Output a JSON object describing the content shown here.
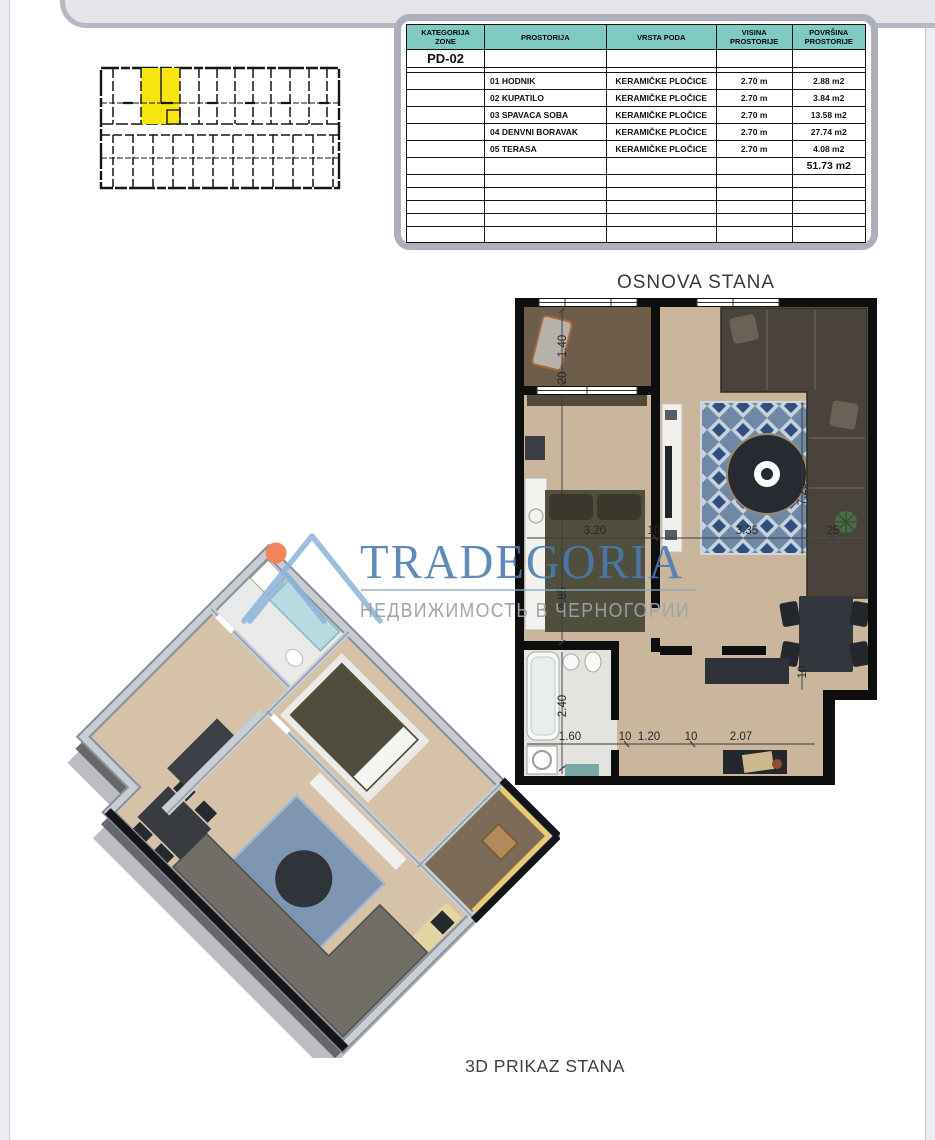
{
  "table": {
    "headers": {
      "col1": "KATEGORIJA\nZONE",
      "col2": "PROSTORIJA",
      "col3": "VRSTA PODA",
      "col4": "VISINA\nPROSTORIJE",
      "col5": "POVRŠINA\nPROSTORIJE"
    },
    "zone": "PD-02",
    "rows": [
      {
        "name": "01 HODNIK",
        "floor": "KERAMIČKE PLOČICE",
        "height": "2.70 m",
        "area": "2.88 m2"
      },
      {
        "name": "02 KUPATILO",
        "floor": "KERAMIČKE PLOČICE",
        "height": "2.70 m",
        "area": "3.84 m2"
      },
      {
        "name": "03 SPAVACA SOBA",
        "floor": "KERAMIČKE PLOČICE",
        "height": "2.70 m",
        "area": "13.58 m2"
      },
      {
        "name": "04 DENVNI BORAVAK",
        "floor": "KERAMIČKE PLOČICE",
        "height": "2.70 m",
        "area": "27.74 m2"
      },
      {
        "name": "05 TERASA",
        "floor": "KERAMIČKE PLOČICE",
        "height": "2.70 m",
        "area": "4.08 m2"
      }
    ],
    "total_area": "51.73 m2",
    "header_color": "#7fcac3"
  },
  "key_plan": {
    "highlight_color": "#f6e50f"
  },
  "floor_plan": {
    "title": "OSNOVA STANA",
    "dims": {
      "terrace_depth": "1.40",
      "terrace_wall": "20",
      "bedroom_depth": "4.85",
      "bedroom_width": "3.20",
      "wall_a": "10",
      "living_width": "3.35",
      "wall_b": "25",
      "living_depth": "7.25",
      "bath_depth": "2.40",
      "bath_width": "1.60",
      "wall_c": "10",
      "hall_width": "1.20",
      "wall_d": "10",
      "nook_width": "2.07",
      "wall_e": "10"
    }
  },
  "render_3d": {
    "title": "3D PRIKAZ STANA"
  },
  "watermark": {
    "brand": "TRADEGORIA",
    "tagline": "НЕДВИЖИМОСТЬ В ЧЕРНОГОРИИ",
    "brand_color": "#4a7cb2",
    "tagline_color": "#9aa2aa",
    "dot_color": "#f2845c",
    "mountain_color": "#8db3d8"
  },
  "colors": {
    "floor_beige": "#c9b69c",
    "terrace_floor": "#6f5d4c",
    "wall_black": "#0e0e0e",
    "rug_blue": "#6e88a6",
    "sofa_dark": "#49433c",
    "bed_olive": "#504e3c",
    "wall_3d_gray": "#c9cdd4",
    "terrace_wall_3d": "#e8cb6c",
    "frame_gray": "#aeaebc"
  }
}
